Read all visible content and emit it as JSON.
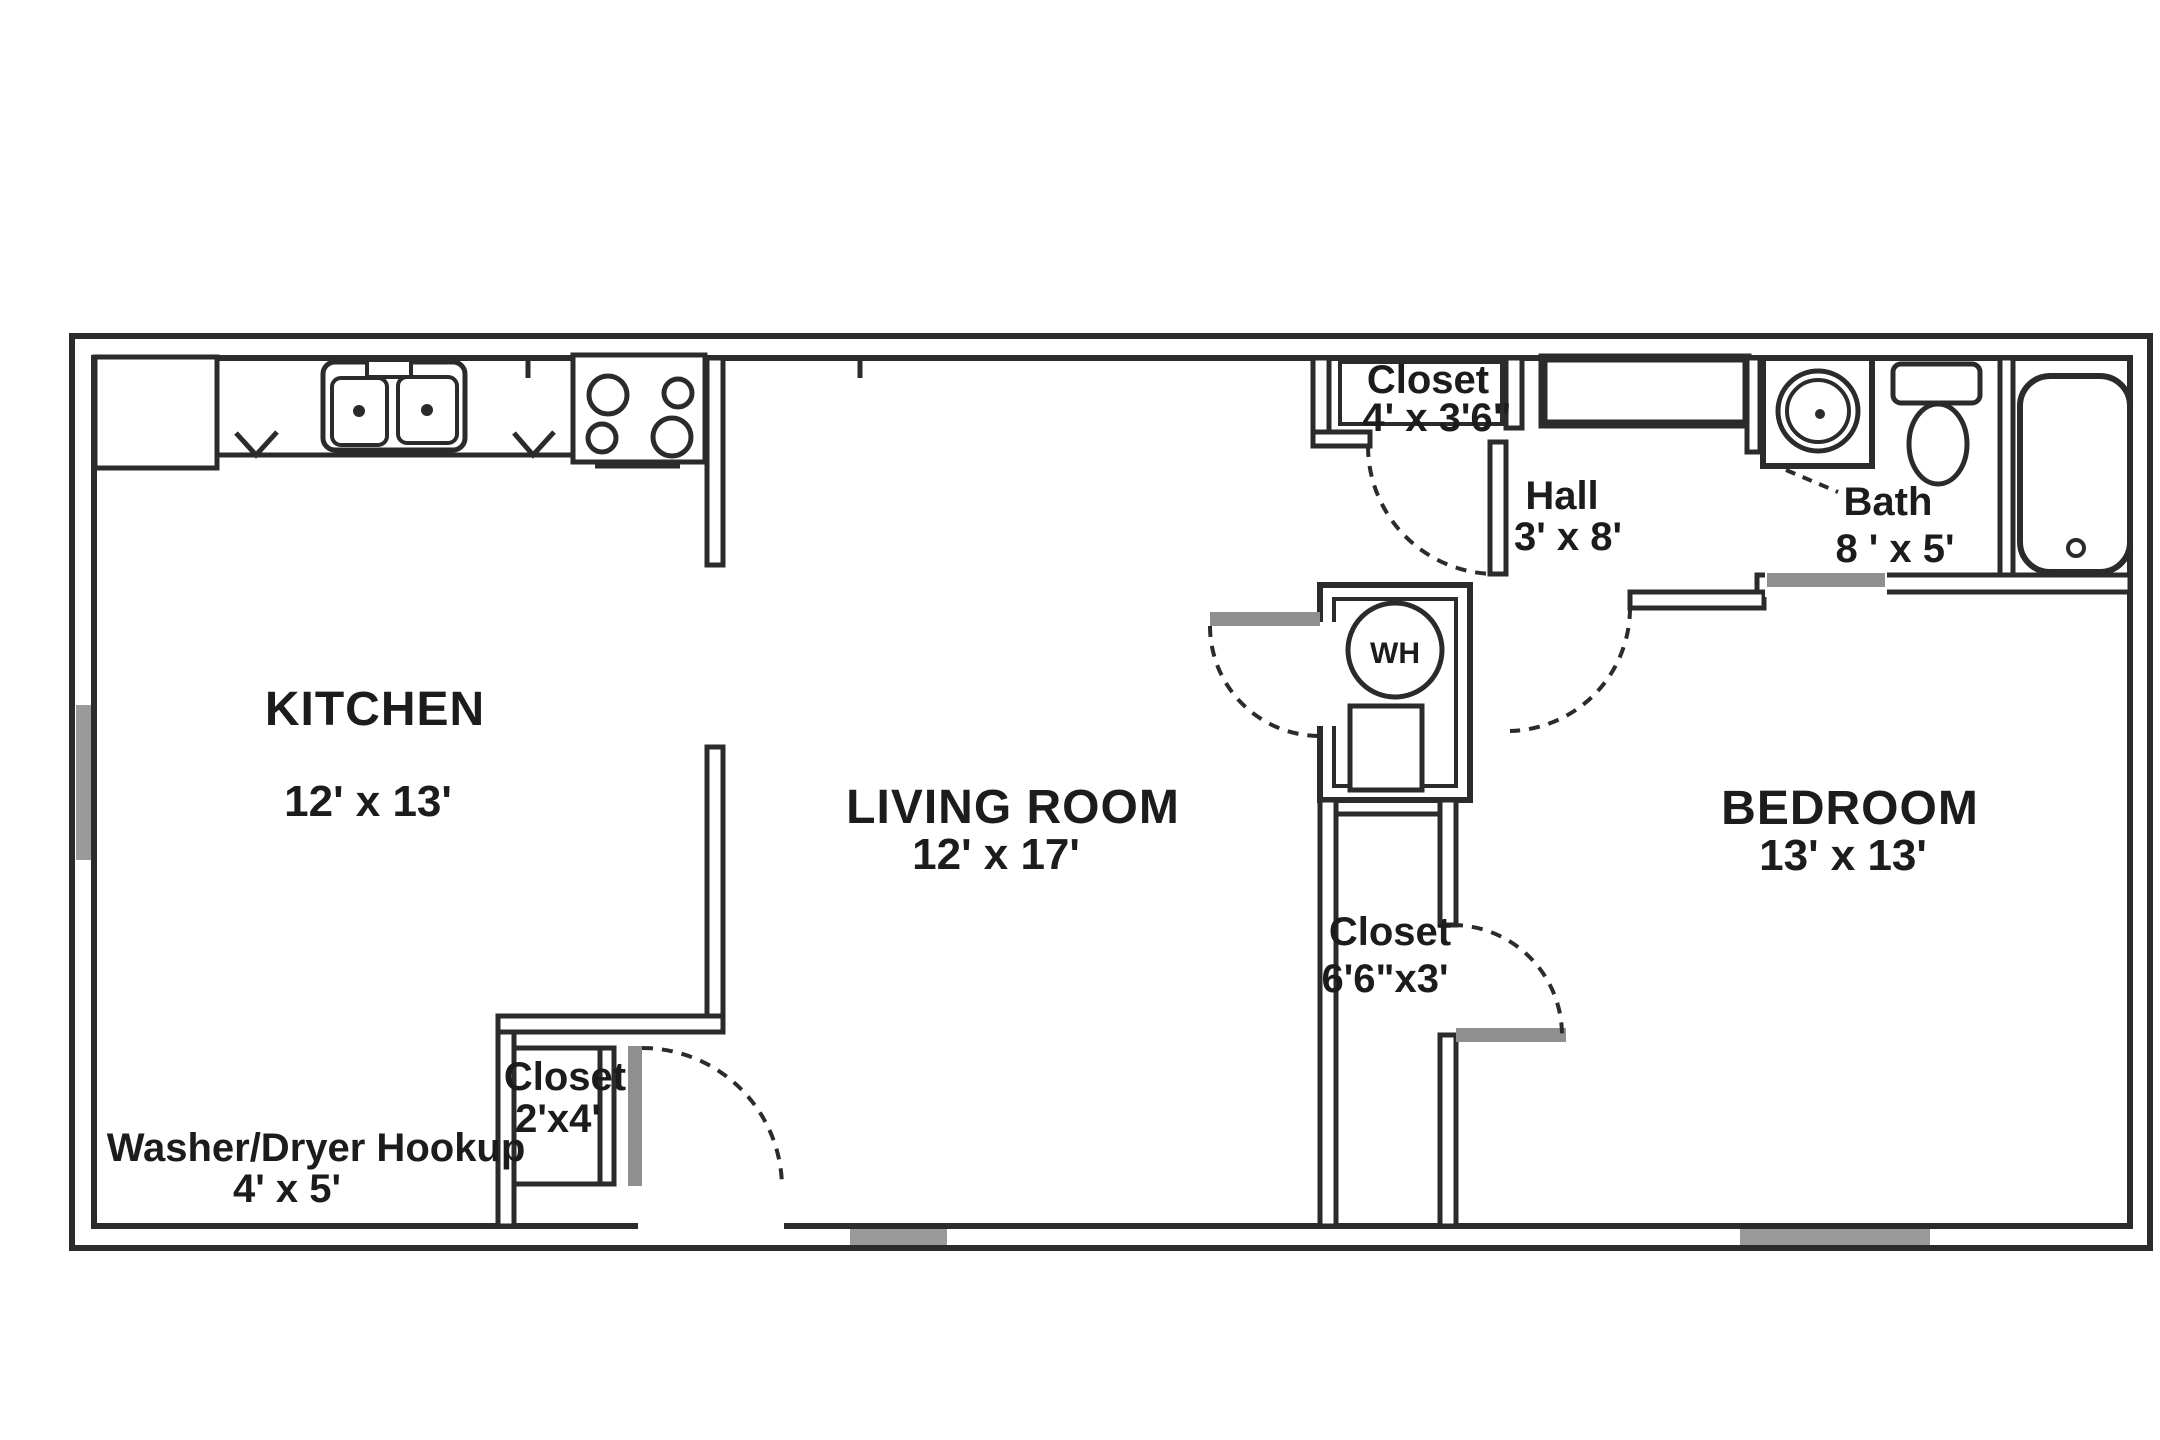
{
  "plan": {
    "kitchen": {
      "name": "KITCHEN",
      "dims": "12' x 13'"
    },
    "living_room": {
      "name": "LIVING ROOM",
      "dims": "12' x 17'"
    },
    "bedroom": {
      "name": "BEDROOM",
      "dims": "13' x 13'"
    },
    "hall": {
      "name": "Hall",
      "dims": "3' x 8'"
    },
    "bath": {
      "name": "Bath",
      "dims": "8 ' x 5'"
    },
    "washer_dryer": {
      "name": "Washer/Dryer Hookup",
      "dims": "4' x 5'"
    },
    "hall_closet": {
      "name": "Closet",
      "dims": "4' x 3'6\""
    },
    "entry_closet": {
      "name": "Closet",
      "dims": "2'x4'"
    },
    "bedroom_closet": {
      "name": "Closet",
      "dims": "6'6\"x3'"
    },
    "water_heater": {
      "abbr": "WH"
    }
  },
  "fixtures": [
    "double-sink",
    "stove",
    "refrigerator",
    "water-heater",
    "furnace-unit",
    "bath-vanity-sink",
    "toilet",
    "bathtub"
  ],
  "colors": {
    "background": "#ffffff",
    "wall": "#2b2b2b",
    "text": "#1c1c1c",
    "door_leaf": "#8f8f8f",
    "window": "#9a9a9a"
  }
}
